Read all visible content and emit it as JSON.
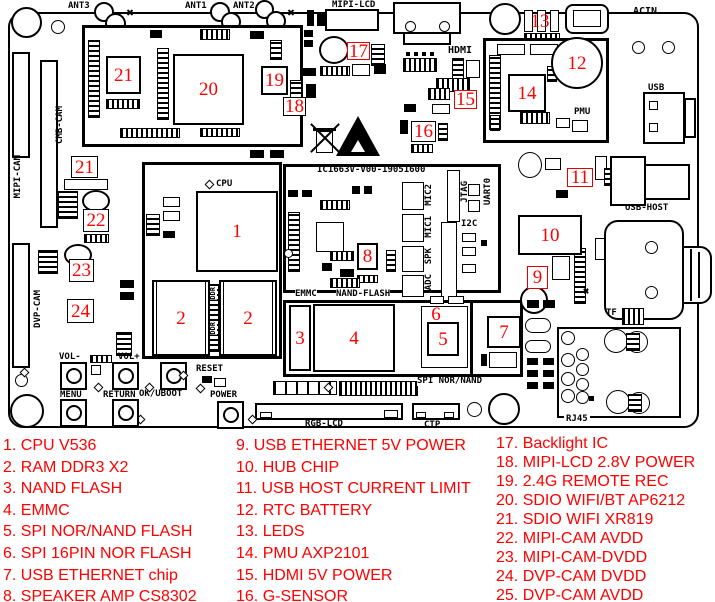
{
  "colors": {
    "marker_red": "#ff0000",
    "line_black": "#000000"
  },
  "board": {
    "id_text": "IC1663V-V00-19051600",
    "labels": {
      "ant3": "ANT3",
      "ant1": "ANT1",
      "ant2": "ANT2",
      "mipi_lcd": "MIPI-LCD",
      "hdmi": "HDMI",
      "acin": "ACIN",
      "usb": "USB",
      "pmu": "PMU",
      "usb_host": "USB-HOST",
      "tf": "TF",
      "rj45": "RJ45",
      "cpu": "CPU",
      "ddr": "DDR",
      "emmc": "EMMC",
      "nand_flash": "NAND-FLASH",
      "spi_nor_nand": "SPI NOR/NAND",
      "rgb_lcd": "RGB-LCD",
      "ctp": "CTP",
      "cmb_cam": "CMB-CAM",
      "mipi_cam": "MIPI-CAM",
      "dvp_cam": "DVP-CAM",
      "vol_minus": "VOL-",
      "vol_plus": "VOL+",
      "menu": "MENU",
      "return": "RETURN",
      "ok_uboot": "OK/UBOOT",
      "reset": "RESET",
      "power": "POWER",
      "mic2": "MIC2",
      "mic1": "MIC1",
      "spk": "SPK",
      "adc": "ADC",
      "jtag": "JTAG",
      "uart0": "UART0",
      "i2c": "I2C"
    },
    "markers": {
      "m1": "1",
      "m2a": "2",
      "m2b": "2",
      "m3": "3",
      "m4": "4",
      "m5": "5",
      "m6": "6",
      "m7": "7",
      "m8": "8",
      "m9": "9",
      "m10": "10",
      "m11": "11",
      "m12": "12",
      "m13": "13",
      "m14": "14",
      "m15": "15",
      "m16": "16",
      "m17": "17",
      "m18": "18",
      "m19": "19",
      "m20": "20",
      "m21": "21",
      "m21b": "21",
      "m22": "22",
      "m23": "23",
      "m24": "24"
    }
  },
  "legend": {
    "columns": [
      {
        "items": [
          "1. CPU V536",
          "2. RAM DDR3 X2",
          "3. NAND FLASH",
          "4. EMMC",
          "5. SPI NOR/NAND FLASH",
          "6. SPI 16PIN NOR FLASH",
          "7. USB ETHERNET chip",
          "8. SPEAKER AMP CS8302"
        ]
      },
      {
        "items": [
          "9. USB ETHERNET 5V POWER",
          "10. HUB CHIP",
          "11. USB HOST CURRENT LIMIT",
          "12. RTC BATTERY",
          "13. LEDS",
          "14. PMU AXP2101",
          "15. HDMI 5V POWER",
          "16. G-SENSOR"
        ]
      },
      {
        "items": [
          "17. Backlight IC",
          "18. MIPI-LCD 2.8V POWER",
          "19. 2.4G REMOTE REC",
          "20. SDIO WIFI/BT AP6212",
          "21. SDIO WIFI XR819",
          "22. MIPI-CAM AVDD",
          "23. MIPI-CAM-DVDD",
          "24. DVP-CAM DVDD",
          "25. DVP-CAM AVDD"
        ]
      }
    ]
  }
}
